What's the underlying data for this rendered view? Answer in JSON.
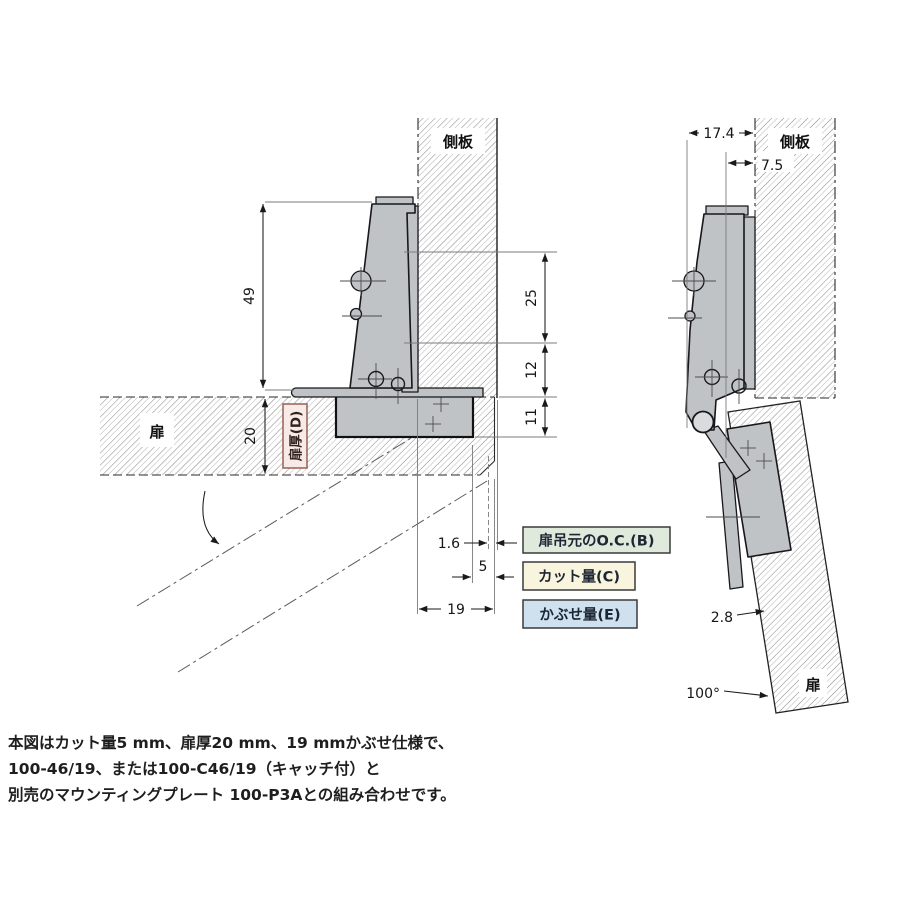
{
  "left_view": {
    "side_panel_label": "側板",
    "door_label": "扉",
    "door_thickness_tag": "扉厚(D)",
    "dim_49": "49",
    "dim_20": "20",
    "dim_25": "25",
    "dim_12": "12",
    "dim_11": "11",
    "dim_1_6": "1.6",
    "dim_5": "5",
    "dim_19": "19"
  },
  "right_view": {
    "side_panel_label": "側板",
    "door_label": "扉",
    "dim_17_4": "17.4",
    "dim_7_5": "7.5",
    "dim_2_8": "2.8",
    "angle": "100°"
  },
  "legend": {
    "items": [
      {
        "label": "扉吊元のO.C.(B)",
        "color": "#dfe9dc"
      },
      {
        "label": "カット量(C)",
        "color": "#f8f4dd"
      },
      {
        "label": "かぶせ量(E)",
        "color": "#cfe0ee"
      }
    ]
  },
  "note": {
    "lines": [
      "本図はカット量5 mm、扉厚20 mm、19 mmかぶせ仕様で、",
      "100-46/19、または100-C46/19（キャッチ付）と",
      "別売のマウンティングプレート 100-P3Aとの組み合わせです。"
    ]
  },
  "colors": {
    "hinge_metal": "#bfc3c5",
    "door_tag_bg": "#f8ebe7",
    "door_tag_border": "#9b6a5e",
    "legend_green": "#dfe9dc",
    "legend_yellow": "#f8f4dd",
    "legend_blue": "#cfe0ee"
  }
}
